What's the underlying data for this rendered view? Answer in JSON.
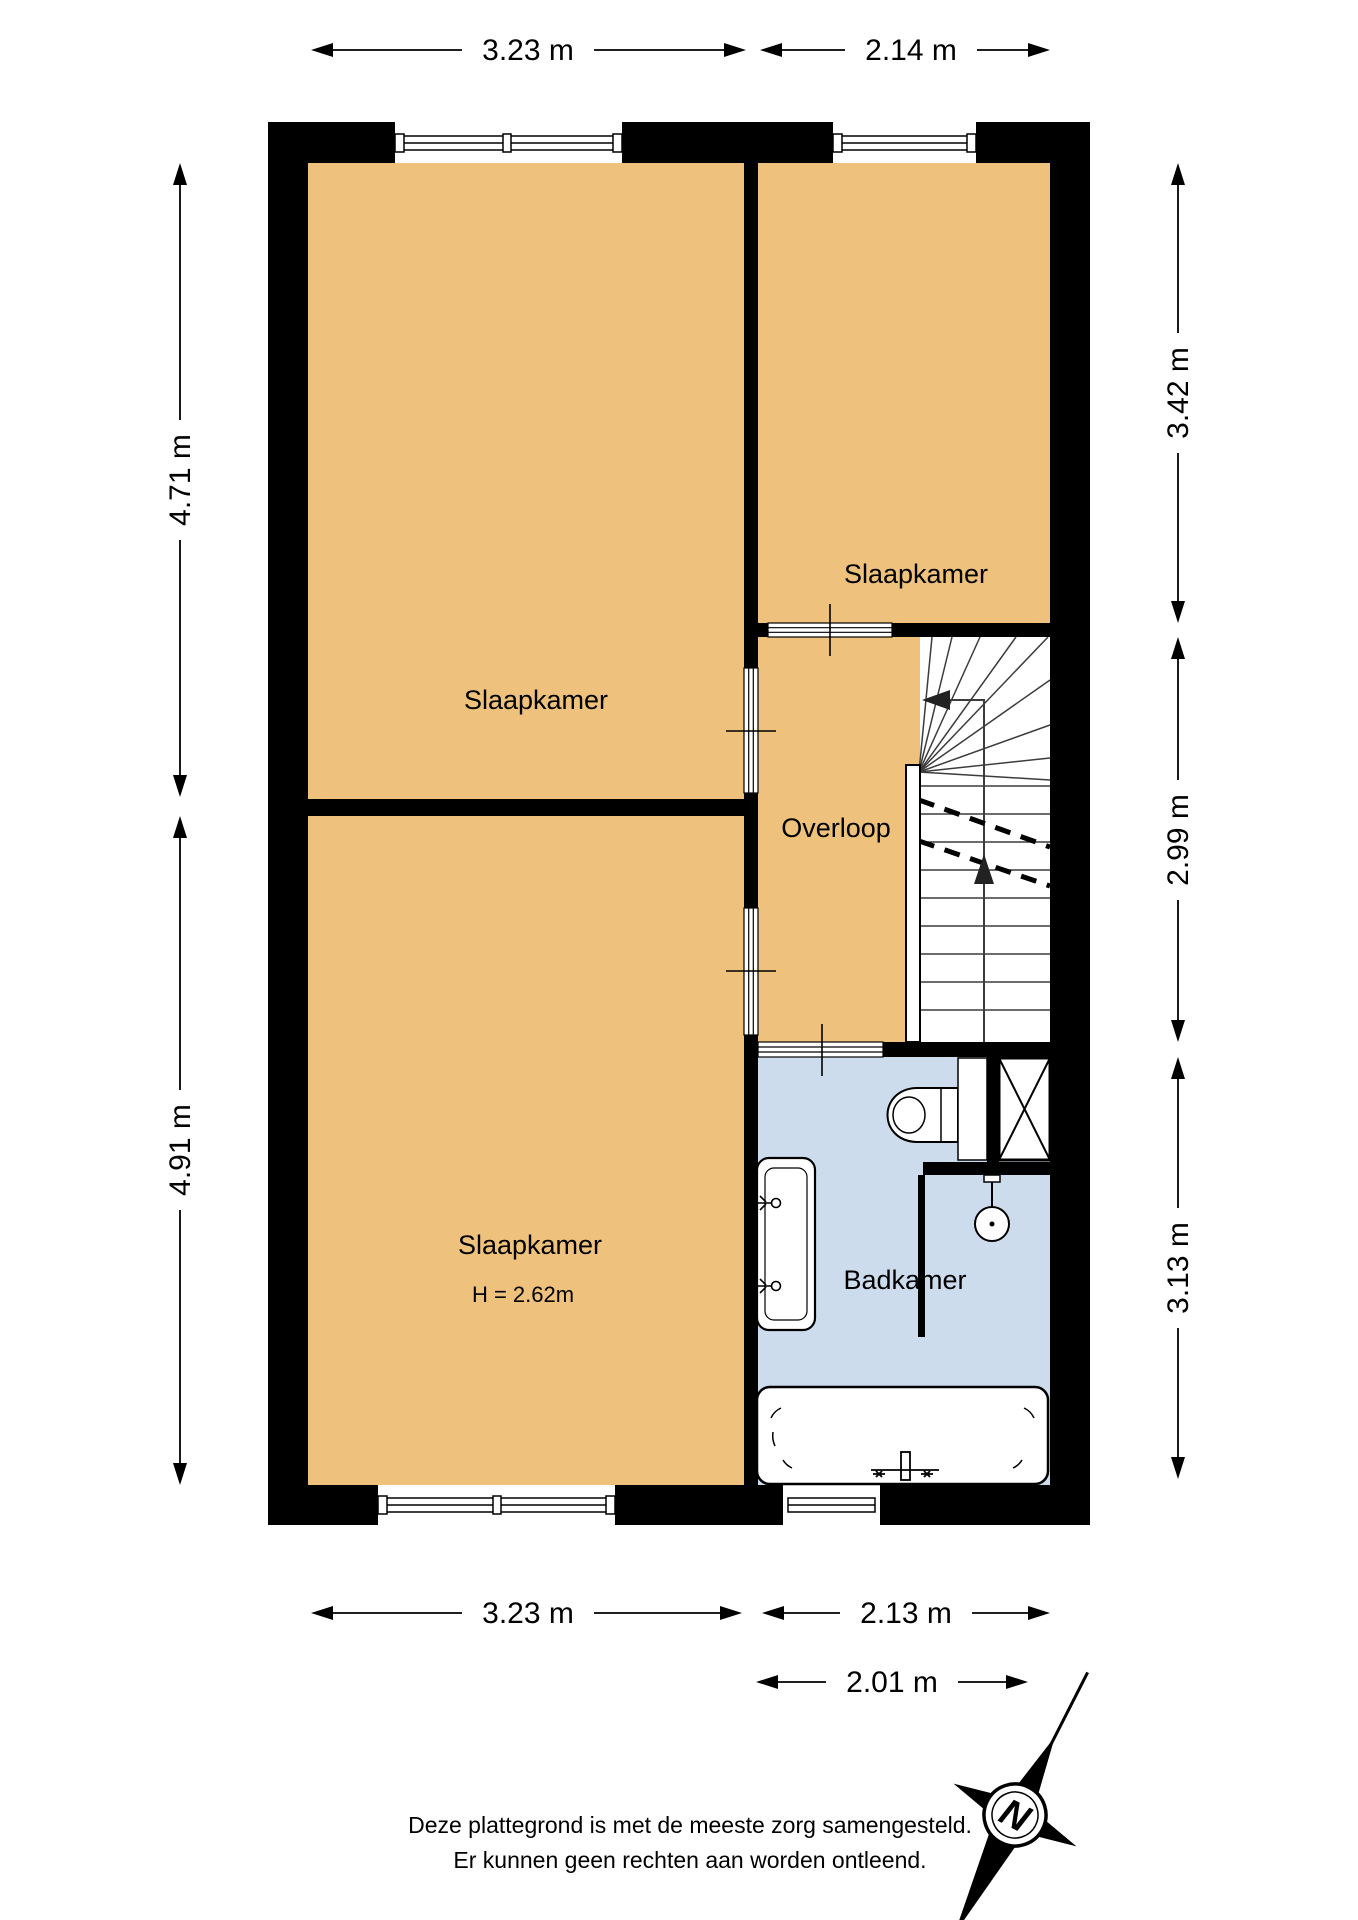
{
  "floorplan": {
    "rooms": [
      {
        "id": "bedroom-top-left",
        "label": "Slaapkamer"
      },
      {
        "id": "bedroom-top-right",
        "label": "Slaapkamer"
      },
      {
        "id": "landing",
        "label": "Overloop"
      },
      {
        "id": "bedroom-bottom-left",
        "label": "Slaapkamer",
        "sublabel": "H = 2.62m"
      },
      {
        "id": "bathroom",
        "label": "Badkamer"
      }
    ],
    "dimensions": {
      "top": [
        {
          "label": "3.23 m"
        },
        {
          "label": "2.14 m"
        }
      ],
      "left": [
        {
          "label": "4.71 m"
        },
        {
          "label": "4.91 m"
        }
      ],
      "right": [
        {
          "label": "3.42 m"
        },
        {
          "label": "2.99 m"
        },
        {
          "label": "3.13 m"
        }
      ],
      "bottom": [
        {
          "label": "3.23 m"
        },
        {
          "label": "2.13 m"
        }
      ],
      "bottom_secondary": [
        {
          "label": "2.01 m"
        }
      ]
    },
    "disclaimer": {
      "line1": "Deze plattegrond is met de meeste zorg samengesteld.",
      "line2": "Er kunnen geen rechten aan worden ontleend."
    },
    "compass": {
      "label": "N"
    },
    "colors": {
      "room": "#eec17c",
      "bathroom": "#cddcec",
      "wall": "#000000",
      "stairs_line": "#3c3c3c"
    }
  }
}
